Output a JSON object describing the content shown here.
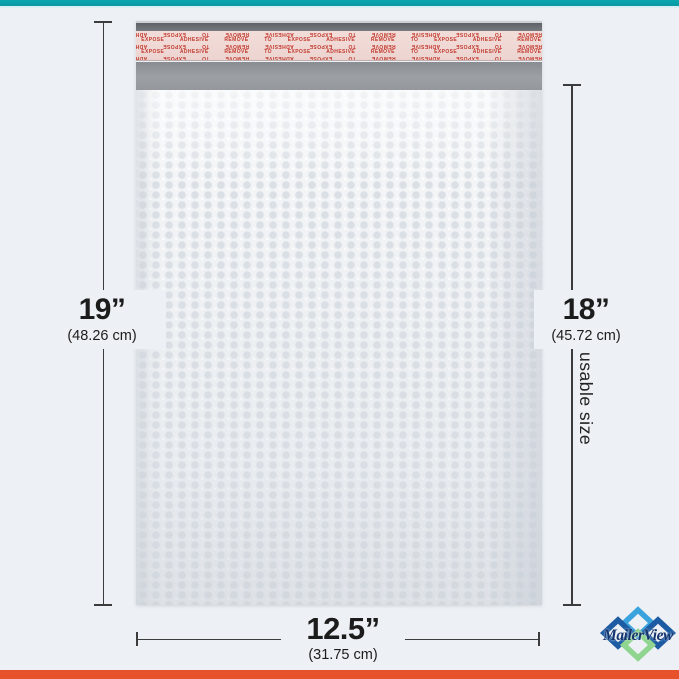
{
  "page": {
    "background": "#edf0f4",
    "top_bar_color": "#0ba0aa",
    "bottom_bar_color": "#e7512b"
  },
  "envelope": {
    "type": "poly bubble mailer",
    "adhesive_text": "REMOVE TO EXPOSE ADHESIVE",
    "body_color": "#f2f4f6",
    "flap_color": "#94989c",
    "liner_color": "#efd8d5",
    "liner_text_color": "#c23a2e"
  },
  "dimensions": {
    "height": {
      "value": "19”",
      "metric": "(48.26 cm)"
    },
    "usable_height": {
      "value": "18”",
      "metric": "(45.72 cm)",
      "note": "usable size"
    },
    "width": {
      "value": "12.5”",
      "metric": "(31.75 cm)"
    }
  },
  "brand": {
    "name": "MailerView",
    "text_color": "#16356e",
    "diamond_light_blue": "#3aa3dd",
    "diamond_dark_blue": "#1d5ca3",
    "diamond_green": "#8fd48f"
  }
}
